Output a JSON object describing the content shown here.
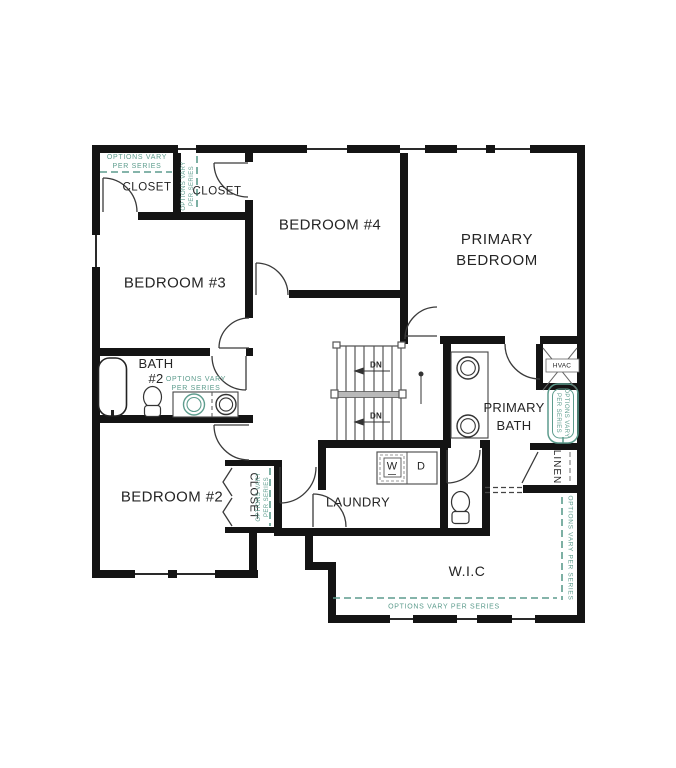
{
  "plan": {
    "rooms": {
      "bedroom2": "BEDROOM #2",
      "bedroom3": "BEDROOM #3",
      "bedroom4": "BEDROOM #4",
      "primary_bedroom": {
        "l1": "PRIMARY",
        "l2": "BEDROOM"
      },
      "primary_bath": {
        "l1": "PRIMARY",
        "l2": "BATH"
      },
      "bath2": {
        "l1": "BATH",
        "l2": "#2"
      },
      "laundry": "LAUNDRY",
      "wic": "W.I.C",
      "closet_bedroom3": "CLOSET",
      "closet_bedroom4": "CLOSET",
      "closet_bedroom2": "CLOSET",
      "linen": "LINEN",
      "hvac": "HVAC"
    },
    "stairs": {
      "down": "DN"
    },
    "appliances": {
      "washer": "W",
      "dryer": "D"
    },
    "annotation": {
      "l1": "OPTIONS VARY",
      "l2": "PER SERIES",
      "full": "OPTIONS VARY PER SERIES"
    },
    "colors": {
      "wall": "#141414",
      "option_teal": "#5d9c8d",
      "text": "#252525"
    }
  }
}
